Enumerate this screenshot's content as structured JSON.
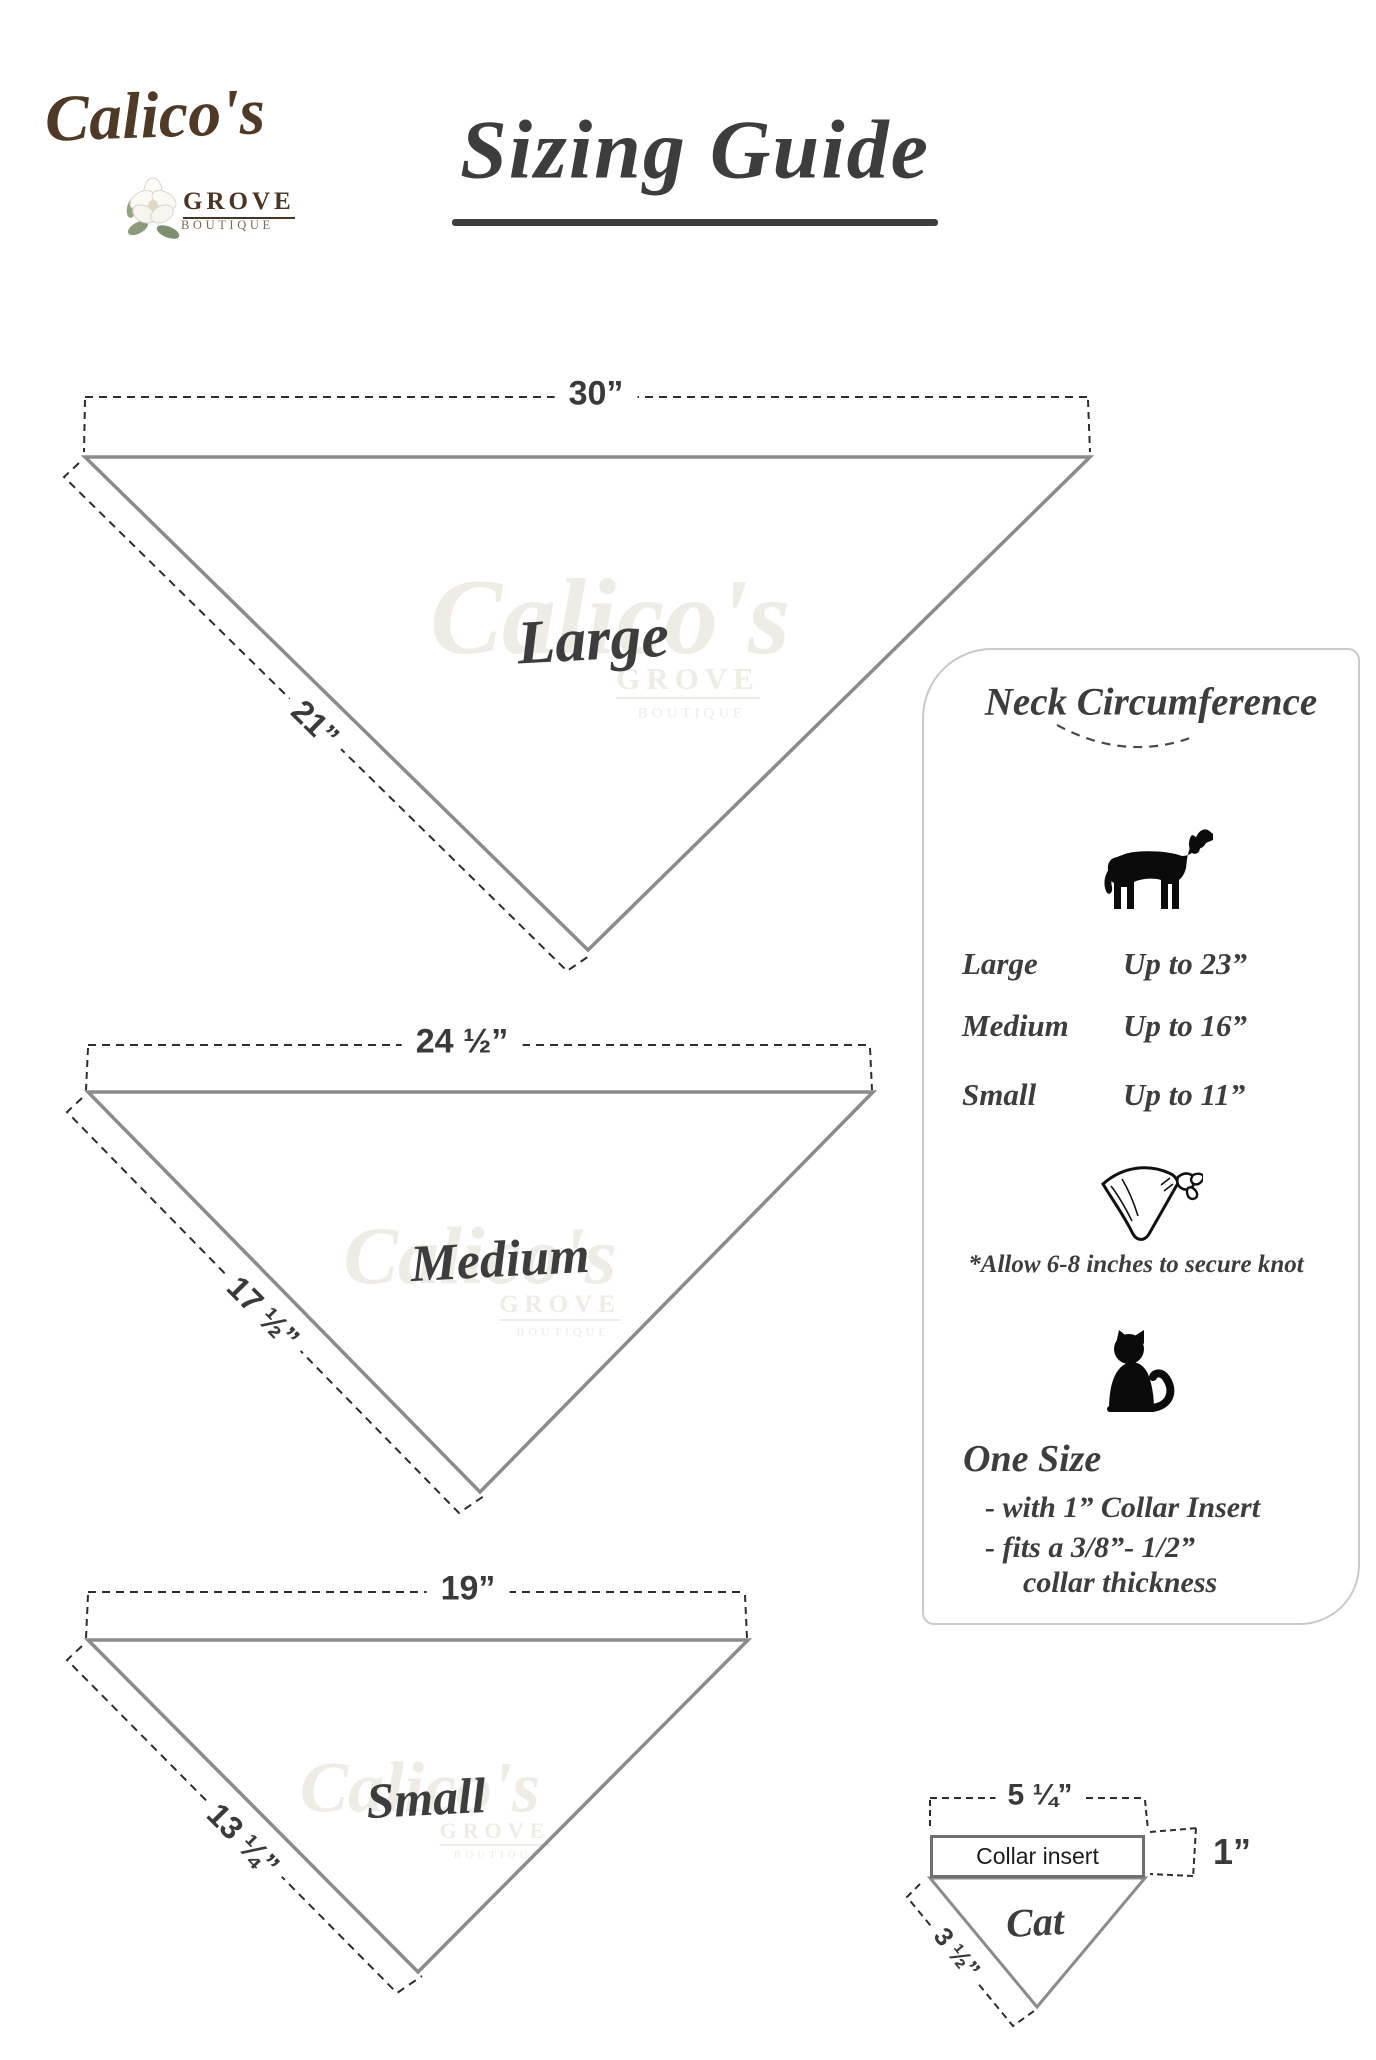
{
  "logo": {
    "brand": "Calico's",
    "grove": "GROVE",
    "boutique": "BOUTIQUE"
  },
  "title": "Sizing Guide",
  "watermark": {
    "brand": "Calico's",
    "grove": "GROVE",
    "boutique": "BOUTIQUE"
  },
  "bandanas": {
    "large": {
      "label": "Large",
      "top_width": "30”",
      "side_length": "21”"
    },
    "medium": {
      "label": "Medium",
      "top_width": "24 ½”",
      "side_length": "17 ½”"
    },
    "small": {
      "label": "Small",
      "top_width": "19”",
      "side_length": "13 ¼”"
    }
  },
  "panel": {
    "heading": "Neck Circumference",
    "rows": [
      {
        "size": "Large",
        "limit": "Up to 23”"
      },
      {
        "size": "Medium",
        "limit": "Up to 16”"
      },
      {
        "size": "Small",
        "limit": "Up to 11”"
      }
    ],
    "knot_note": "*Allow 6-8 inches to secure knot",
    "one_size_heading": "One Size",
    "one_size_line1": "- with 1” Collar Insert",
    "one_size_line2": "- fits a 3/8”- 1/2”",
    "one_size_line3": "collar thickness"
  },
  "cat_diagram": {
    "top_width": "5 ¼”",
    "insert_label": "Collar insert",
    "insert_height": "1”",
    "side_length": "3 ½”",
    "label": "Cat"
  },
  "colors": {
    "ink": "#3d3d3d",
    "triangle_line": "#8b8b8b",
    "dash_line": "#2d2d2d",
    "logo_brown": "#4e3a26",
    "panel_border": "#c9c9c9"
  }
}
